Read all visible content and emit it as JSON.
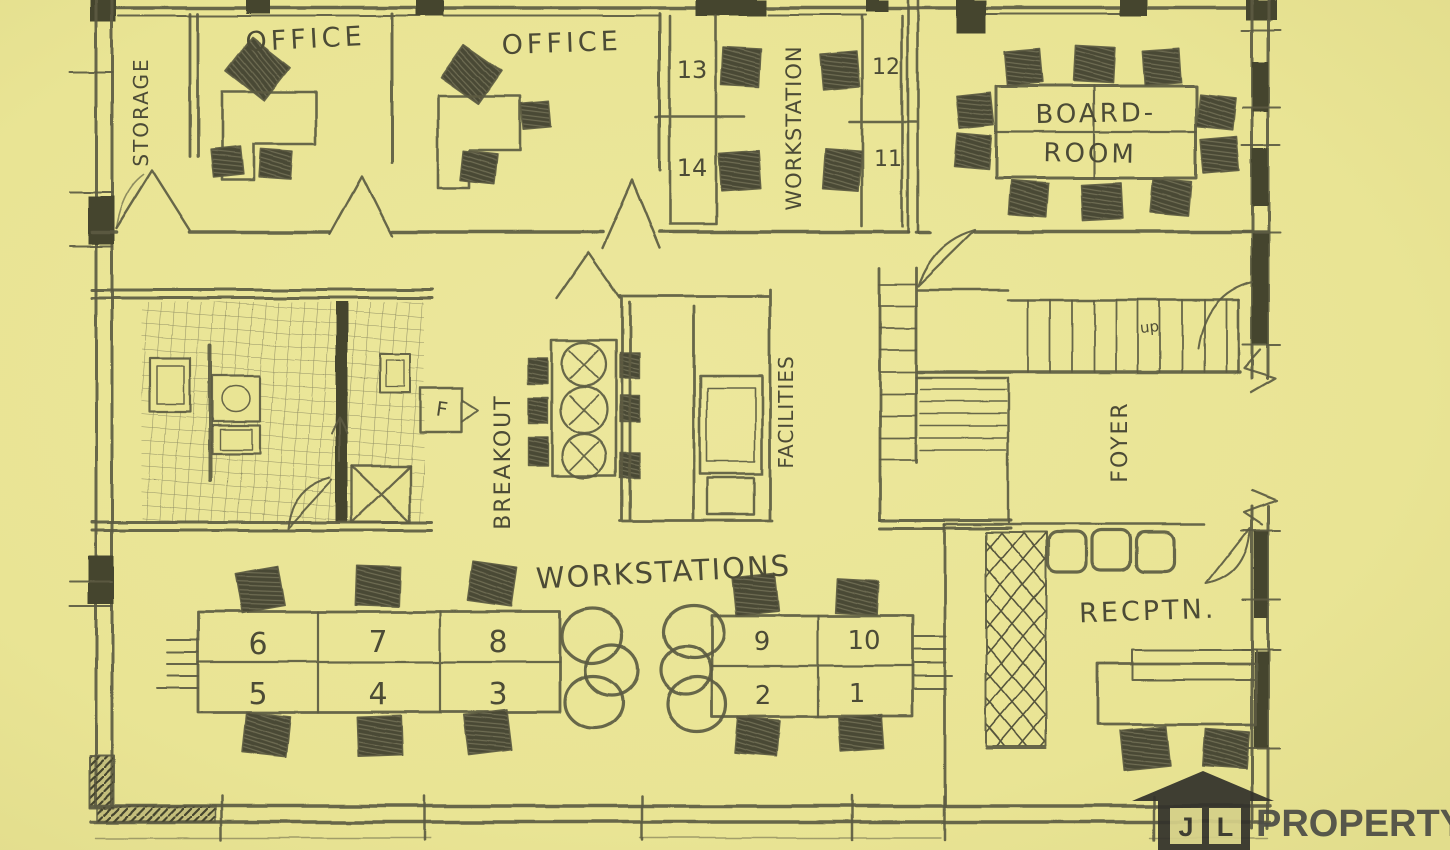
{
  "palette": {
    "paper": "#e9e494",
    "paper_light": "#eee9a0",
    "pencil": "#5c5b42",
    "pencil_dark": "#45442f",
    "logo_dark": "#33322b",
    "logo_text": "#4d4d46"
  },
  "rooms": {
    "storage": "STORAGE",
    "office1": "OFFICE",
    "office2": "OFFICE",
    "workstation_column": "WORKSTATION",
    "boardroom_line1": "BOARD-",
    "boardroom_line2": "ROOM",
    "breakout": "BREAKOUT",
    "facilities": "FACILITIES",
    "foyer": "FOYER",
    "reception": "RECPTN.",
    "workstations": "WORKSTATIONS"
  },
  "annotations": {
    "stairs_direction": "up",
    "fridge": "F"
  },
  "desks": {
    "column_right_upper": [
      "13",
      "14"
    ],
    "column_far_right": [
      "12",
      "11"
    ],
    "left_bank_top": [
      "6",
      "7",
      "8"
    ],
    "left_bank_bottom": [
      "5",
      "4",
      "3"
    ],
    "right_bank_top": [
      "9",
      "10"
    ],
    "right_bank_bottom": [
      "2",
      "1"
    ]
  },
  "logo": {
    "initial_left": "J",
    "initial_right": "L",
    "brand": "PROPERTY"
  }
}
